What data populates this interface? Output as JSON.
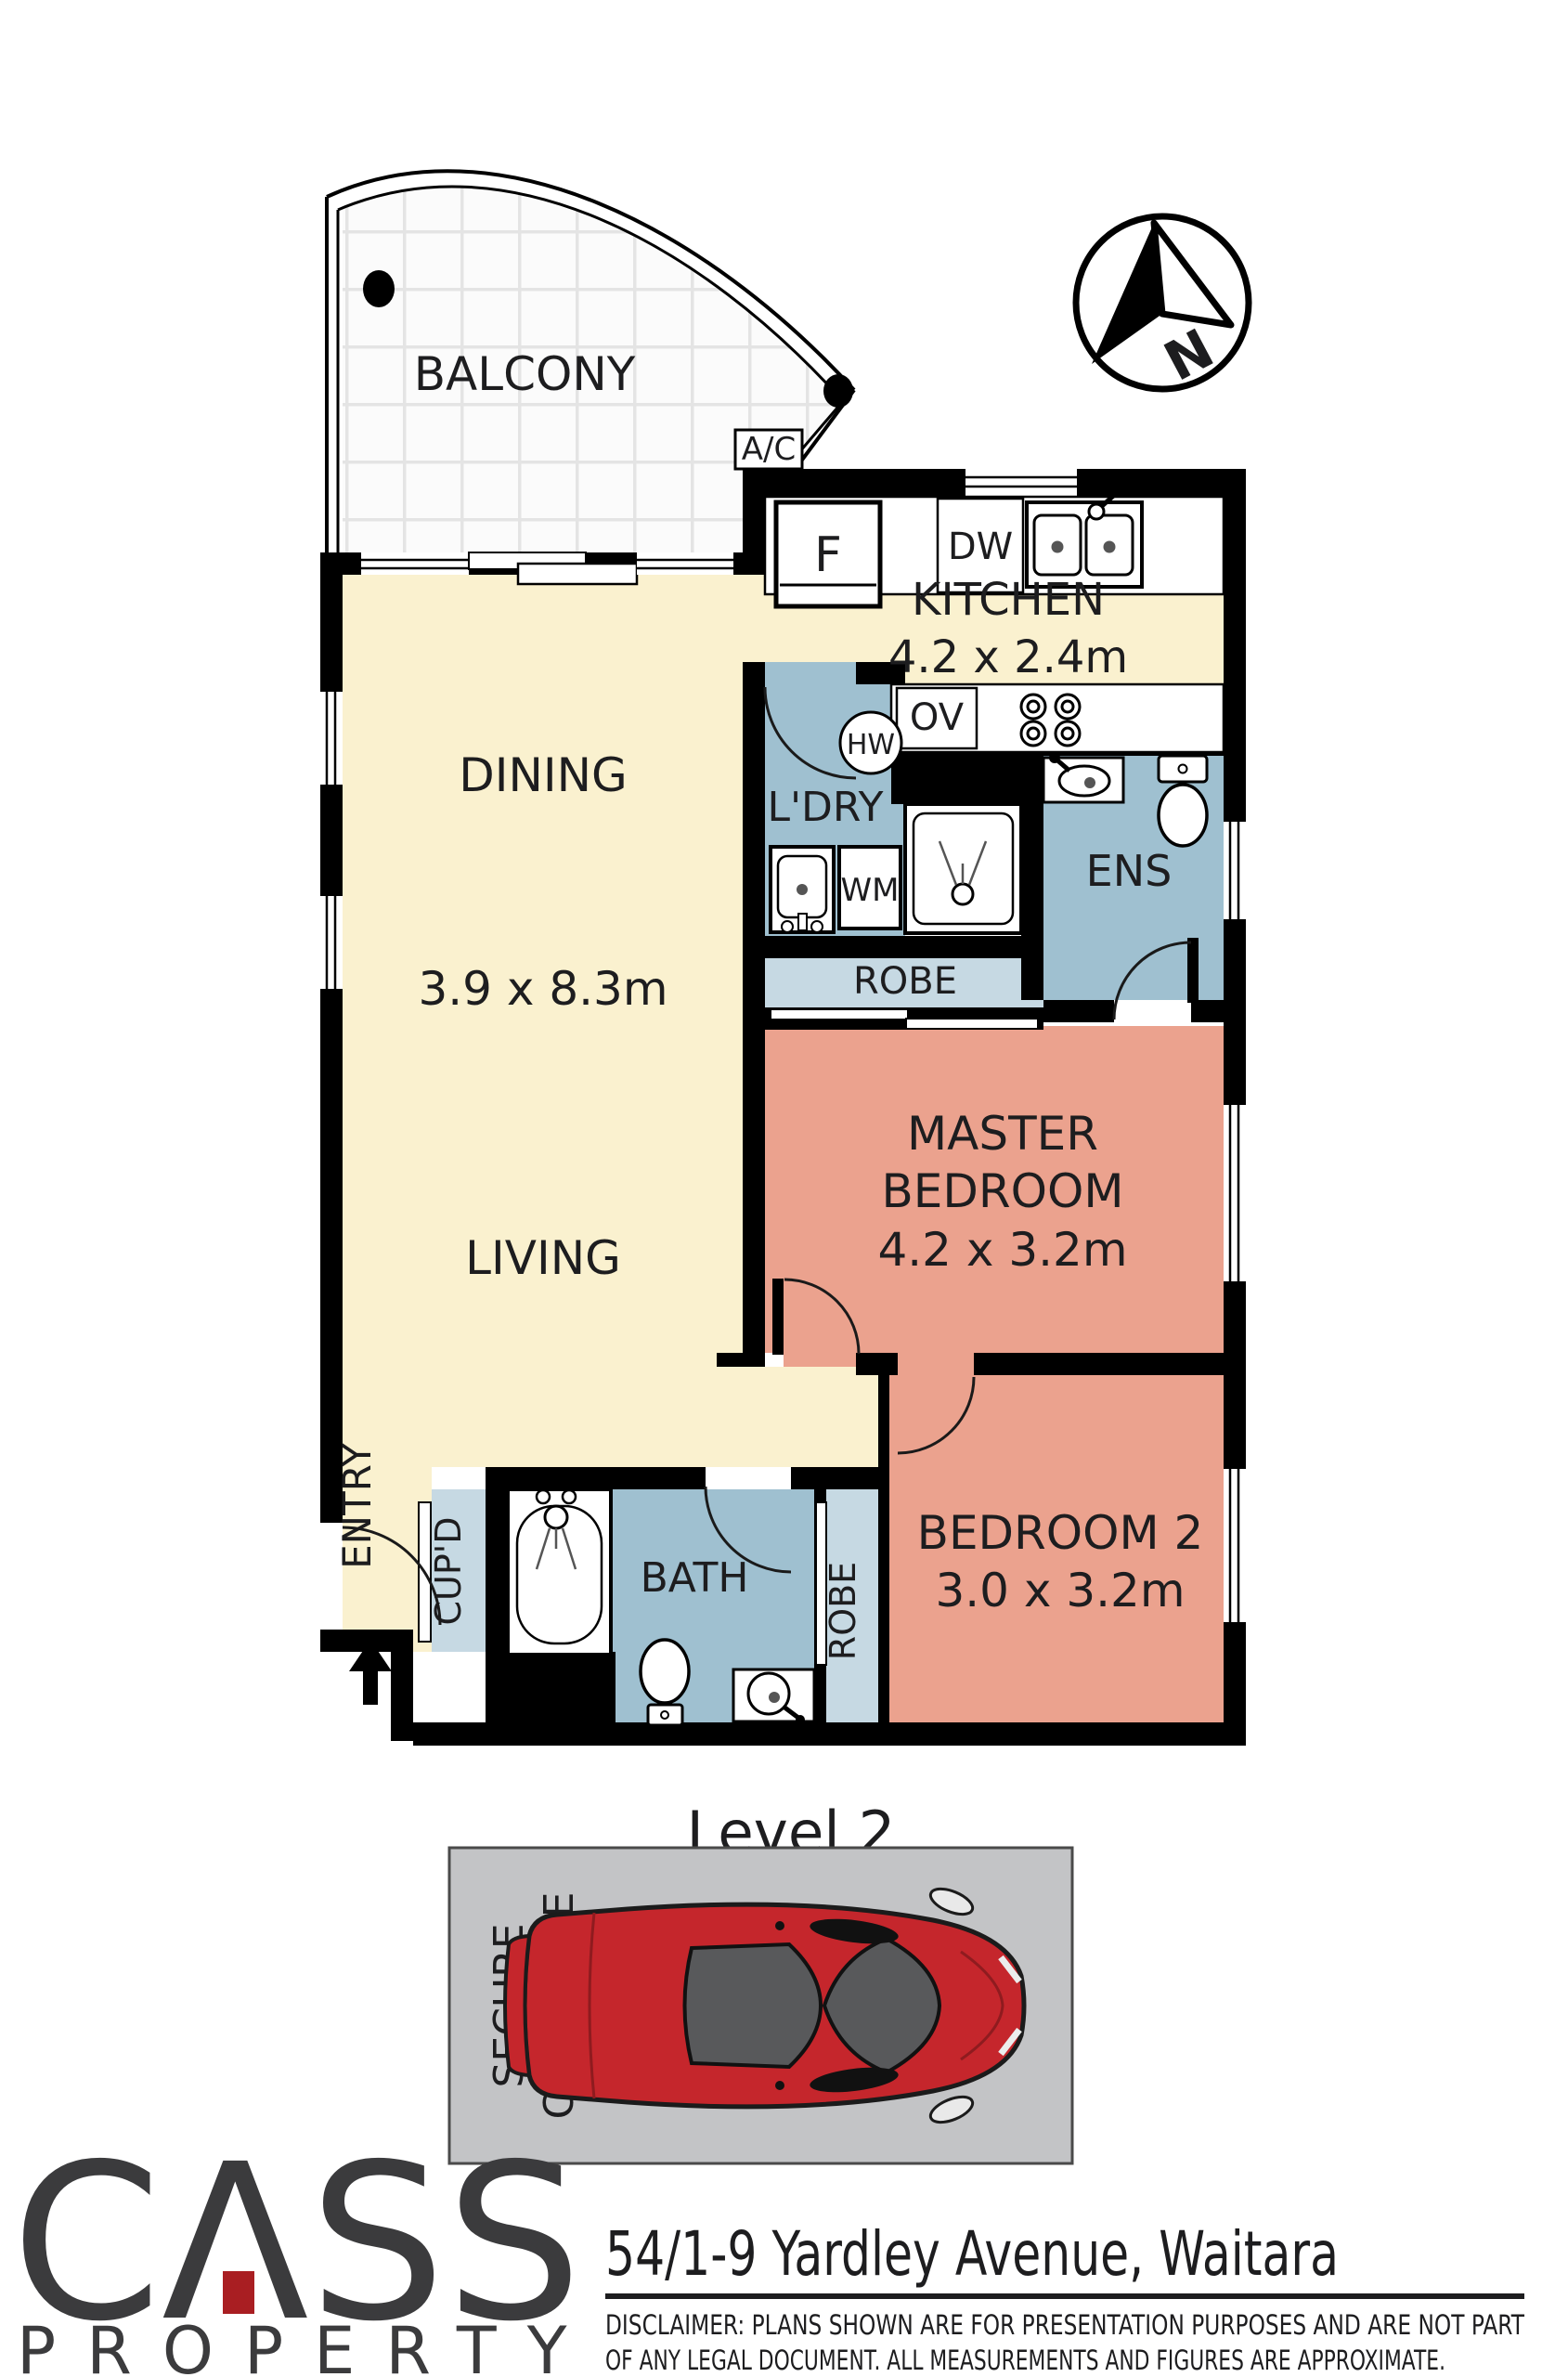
{
  "title": "Floor plan - 54/1-9 Yardley Avenue, Waitara",
  "compass": {
    "north_label": "N"
  },
  "rooms": {
    "balcony": {
      "name": "BALCONY"
    },
    "kitchen": {
      "name": "KITCHEN",
      "dims": "4.2 x 2.4m"
    },
    "dining": {
      "name": "DINING"
    },
    "living": {
      "name": "LIVING",
      "dims": "3.9 x 8.3m"
    },
    "laundry": {
      "name": "L'DRY"
    },
    "ensuite": {
      "name": "ENS"
    },
    "robe_master": {
      "name": "ROBE"
    },
    "master": {
      "name_line1": "MASTER",
      "name_line2": "BEDROOM",
      "dims": "4.2 x 3.2m"
    },
    "bedroom2": {
      "name": "BEDROOM 2",
      "dims": "3.0 x 3.2m"
    },
    "bath": {
      "name": "BATH"
    },
    "robe2": {
      "name": "ROBE"
    },
    "cupboard": {
      "name": "CUP'D"
    },
    "entry": {
      "name": "ENTRY"
    }
  },
  "fixtures": {
    "ac": "A/C",
    "fridge": "F",
    "dishwasher": "DW",
    "oven": "OV",
    "hot_water": "HW",
    "washing_machine": "WM"
  },
  "level_label": "Level 2",
  "car_space": {
    "line1": "SECURE",
    "line2": "CAR SPACE"
  },
  "branding": {
    "logo_c": "C",
    "logo_a": "Λ",
    "logo_ss": "SS",
    "logo_word2": "PROPERTY"
  },
  "address": "54/1-9 Yardley Avenue, Waitara",
  "disclaimer_line1": "DISCLAIMER:  PLANS SHOWN ARE FOR PRESENTATION PURPOSES AND ARE NOT PART",
  "disclaimer_line2": "OF ANY LEGAL DOCUMENT. ALL MEASUREMENTS AND FIGURES ARE APPROXIMATE.",
  "colors": {
    "living_cream": "#faf1cf",
    "wet_blue": "#9fc0d0",
    "robe_light_blue": "#c6d9e3",
    "bedroom_salmon": "#eba28e",
    "car_space_grey": "#c3c4c6",
    "car_red": "#c5262c",
    "logo_charcoal": "#3b3b3d",
    "logo_red": "#a91e22"
  }
}
